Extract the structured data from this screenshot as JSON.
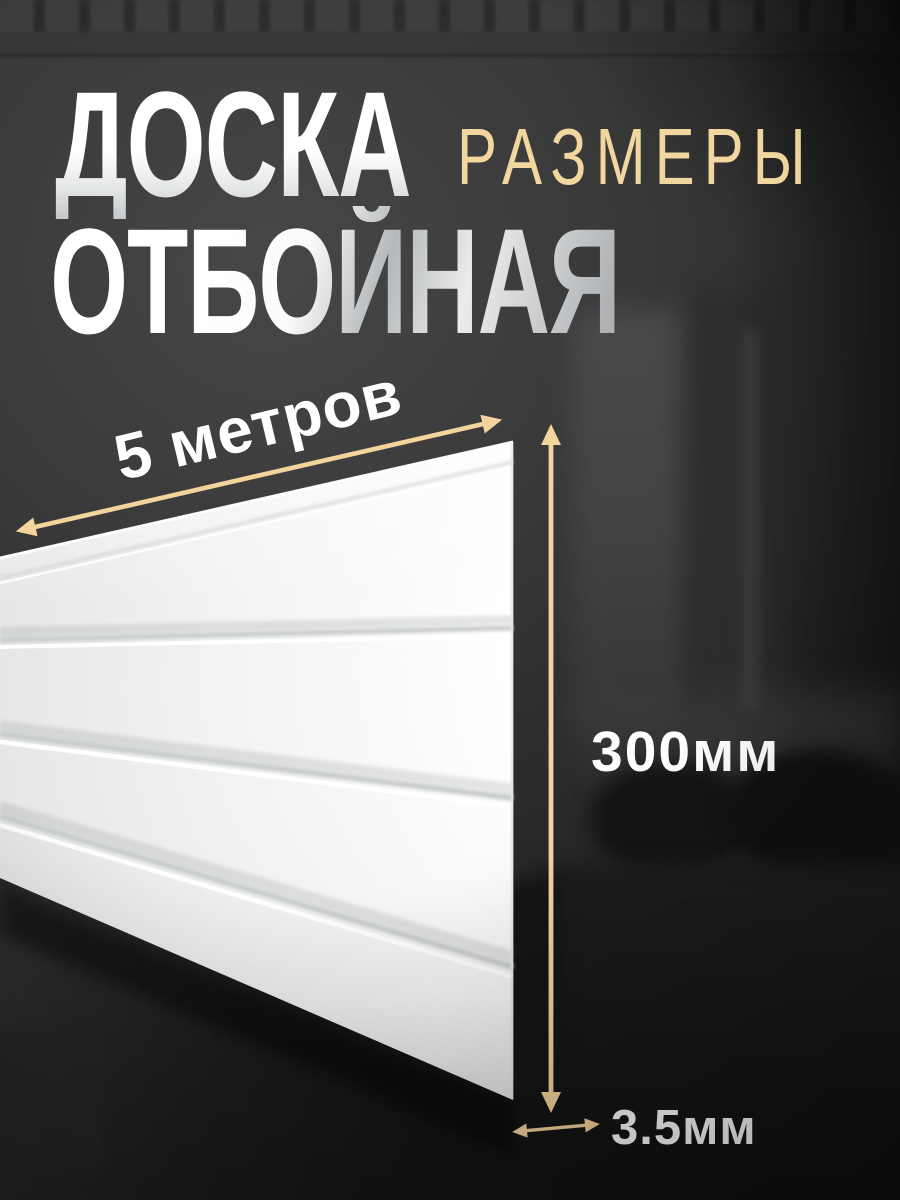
{
  "banner": {
    "title_line1": "ДОСКА",
    "title_line2": "ОТБОЙНАЯ",
    "sizes_badge": "РАЗМЕРЫ"
  },
  "dimensions": {
    "length": "5 метров",
    "height": "300мм",
    "thickness": "3.5мм"
  },
  "colors": {
    "accent_gold": "#f2d49c",
    "board_white": "#f4f4f4",
    "background_dark": "#2b2b2b",
    "text_white": "#ffffff"
  },
  "icons": {
    "length_arrow": "double-headed-diagonal-arrow",
    "height_arrow": "double-headed-vertical-arrow",
    "thickness_arrow": "double-headed-horizontal-arrow"
  }
}
